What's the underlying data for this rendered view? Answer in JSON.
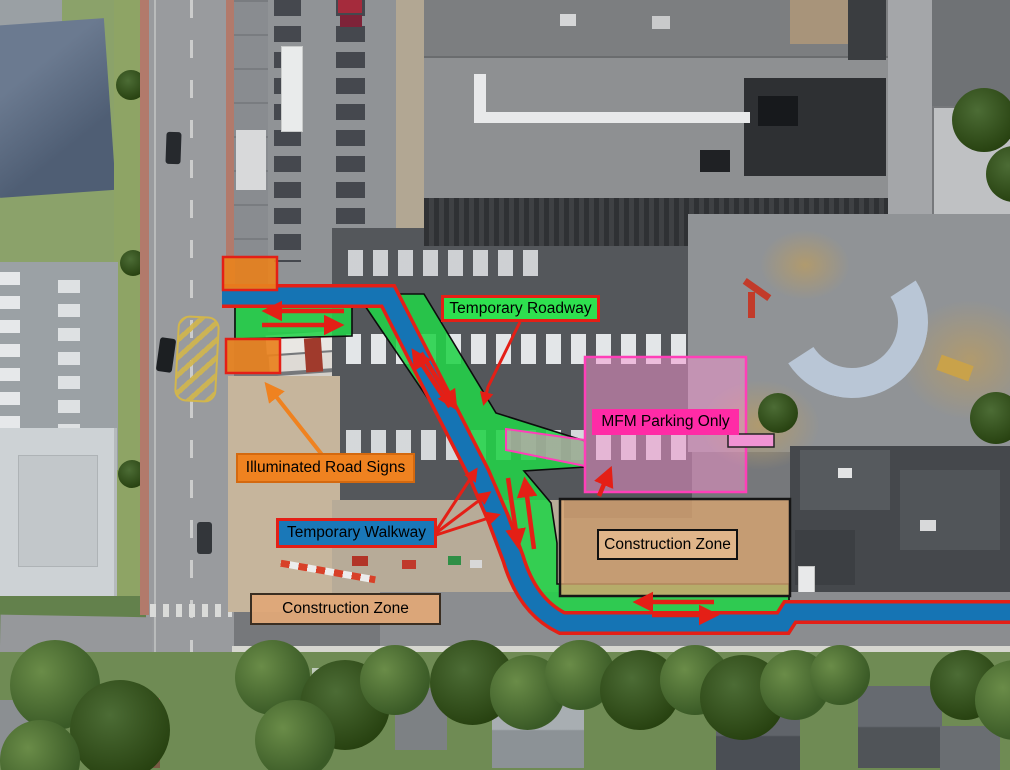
{
  "scene": {
    "description": "Aerial drone photograph of a downtown construction site annotated with a temporary traffic and pedestrian plan"
  },
  "annotations": {
    "labels": [
      {
        "id": "temporary-roadway",
        "text": "Temporary Roadway",
        "bg": "#2ee04f",
        "border": "#e41f16",
        "text_color": "#000000"
      },
      {
        "id": "mfm-parking",
        "text": "MFM Parking Only",
        "bg": "#ff2ba6",
        "border": "#ff2ba6",
        "text_color": "#000000"
      },
      {
        "id": "illuminated-road-signs",
        "text": "Illuminated Road Signs",
        "bg": "#ef8220",
        "border": "#d4690f",
        "text_color": "#000000"
      },
      {
        "id": "temporary-walkway",
        "text": "Temporary Walkway",
        "bg": "#1a78b8",
        "border": "#e41f16",
        "text_color": "#000000"
      },
      {
        "id": "construction-zone-1",
        "text": "Construction Zone",
        "bg": "rgba(226,184,141,0.9)",
        "border": "#111111",
        "text_color": "#000000"
      },
      {
        "id": "construction-zone-2",
        "text": "Construction Zone",
        "bg": "rgba(223,168,120,0.95)",
        "border": "#3a2e22",
        "text_color": "#000000"
      }
    ],
    "overlays": {
      "roadway_fill": "#22d348",
      "walkway_fill": "#1574b4",
      "walkway_outline": "#e41f16",
      "parking_zone_fill": "#f593d0",
      "parking_zone_border": "#ff3fb8",
      "parking_sign_small_fill": "#f193d3",
      "parking_sign_small_border": "#222222",
      "construction_zone_fill": "#d9a572",
      "construction_zone_border": "#161616",
      "sign_box_fill": "#e8821e",
      "sign_box_border": "#e41f16",
      "arrow_color": "#e41f16",
      "sign_pointer_color": "#ef8220"
    },
    "illuminated_sign_boxes": 2,
    "traffic_direction": "two-way"
  }
}
